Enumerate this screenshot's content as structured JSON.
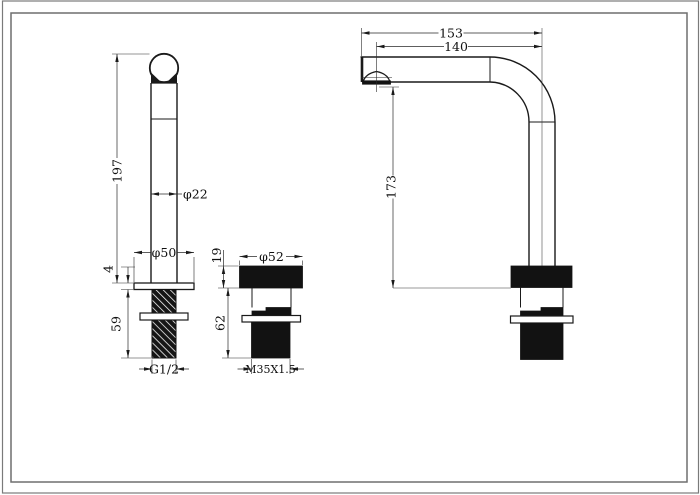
{
  "title": "Faucet dimensional drawing",
  "colors": {
    "line": "#1a1a1a",
    "frame": "#7a7a7a",
    "counter_line": "#9a9a9a"
  },
  "views": {
    "front": {
      "dims": {
        "height": "197",
        "tube_dia": "φ22",
        "flange_dia": "φ50",
        "flange_thickness": "4",
        "shank_length": "59",
        "thread": "G1/2"
      }
    },
    "valve": {
      "dims": {
        "cap_height": "19",
        "cap_dia": "φ52",
        "body_length": "62",
        "thread": "M35X1.5"
      }
    },
    "side": {
      "dims": {
        "reach_outer": "153",
        "reach_center": "140",
        "outlet_height": "173"
      }
    }
  }
}
